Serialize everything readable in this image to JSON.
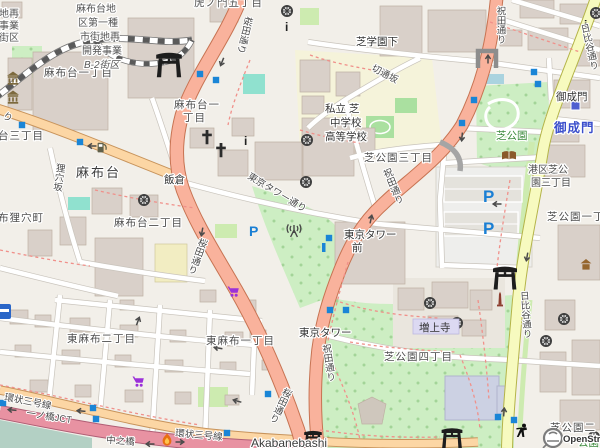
{
  "districts": {
    "toranomon5": "虎ノ門五丁目",
    "azabudai1": "麻布台一丁目",
    "azabudai1b_l1": "麻布台一",
    "azabudai1b_l2": "丁目",
    "azabudai3_cut": "台三丁目",
    "mamianacho_cut": "布狸穴町",
    "azabudai2": "麻布台二丁目",
    "higashiazabu2": "東麻布二丁目",
    "higashiazabu1": "東麻布一丁目",
    "shibakoen3": "芝公園三丁目",
    "shibakoen4": "芝公園四丁目",
    "shibakoen1_cut": "芝公園一丁",
    "shibakoen2_cut": "芝公園二",
    "minatoku_l1": "港区芝公",
    "minatoku_l2": "園三丁目",
    "redev_l1": "麻布台地",
    "redev_l2": "区第一種",
    "redev_l3": "市街地再",
    "redev_l4": "開発事業",
    "redev_l5": "B-2街区",
    "redev_cut_l1": "地再",
    "redev_cut_l2": "事業",
    "redev_cut_l3": "街区"
  },
  "roads": {
    "sakurada": "桜田通り",
    "iwaida": "祝田通り",
    "hibiya": "日比谷通り",
    "tokyotower_st": "東京タワー通り",
    "kanjo3": "環状三号線",
    "kiritoshizaka": "切通坂",
    "mamianazaka": "狸穴坂",
    "gaien_cut": "り",
    "ichinohashi_jct": "一ノ橋JCT",
    "nakanohashi": "中之橋",
    "akabanebashi_en": "Akabanebashi",
    "shibagakuenshita": "芝学園下"
  },
  "places": {
    "azabudai": "麻布台",
    "iikura": "飯倉",
    "onarimon": "御成門",
    "onarimon_station": "御成門",
    "tokyotower_mae_l1": "東京タワー",
    "tokyotower_mae_l2": "前",
    "tokyotower": "東京タワー",
    "zojoji": "増上寺",
    "shibapark": "芝公園",
    "shibapark_cut": "公園",
    "school_l1": "私立 芝",
    "school_l2": "中学校",
    "school_l3": "高等学校"
  },
  "icons": {
    "parking_letter": "P",
    "info_letter": "i"
  },
  "colors": {
    "background": "#f2efe9",
    "building": "#d9d0c9",
    "trunk_road": "#f9b29c",
    "primary_road": "#fcd6a4",
    "secondary_road": "#f7fabf",
    "motorway": "#e892a2",
    "park": "#cdeec3",
    "water_pool": "#90e1cf",
    "signal_blue": "#1a85d6",
    "station_blue": "#4f5fd0",
    "supermarket_purple": "#9b30d9"
  },
  "attribution": "OpenStreetMap"
}
